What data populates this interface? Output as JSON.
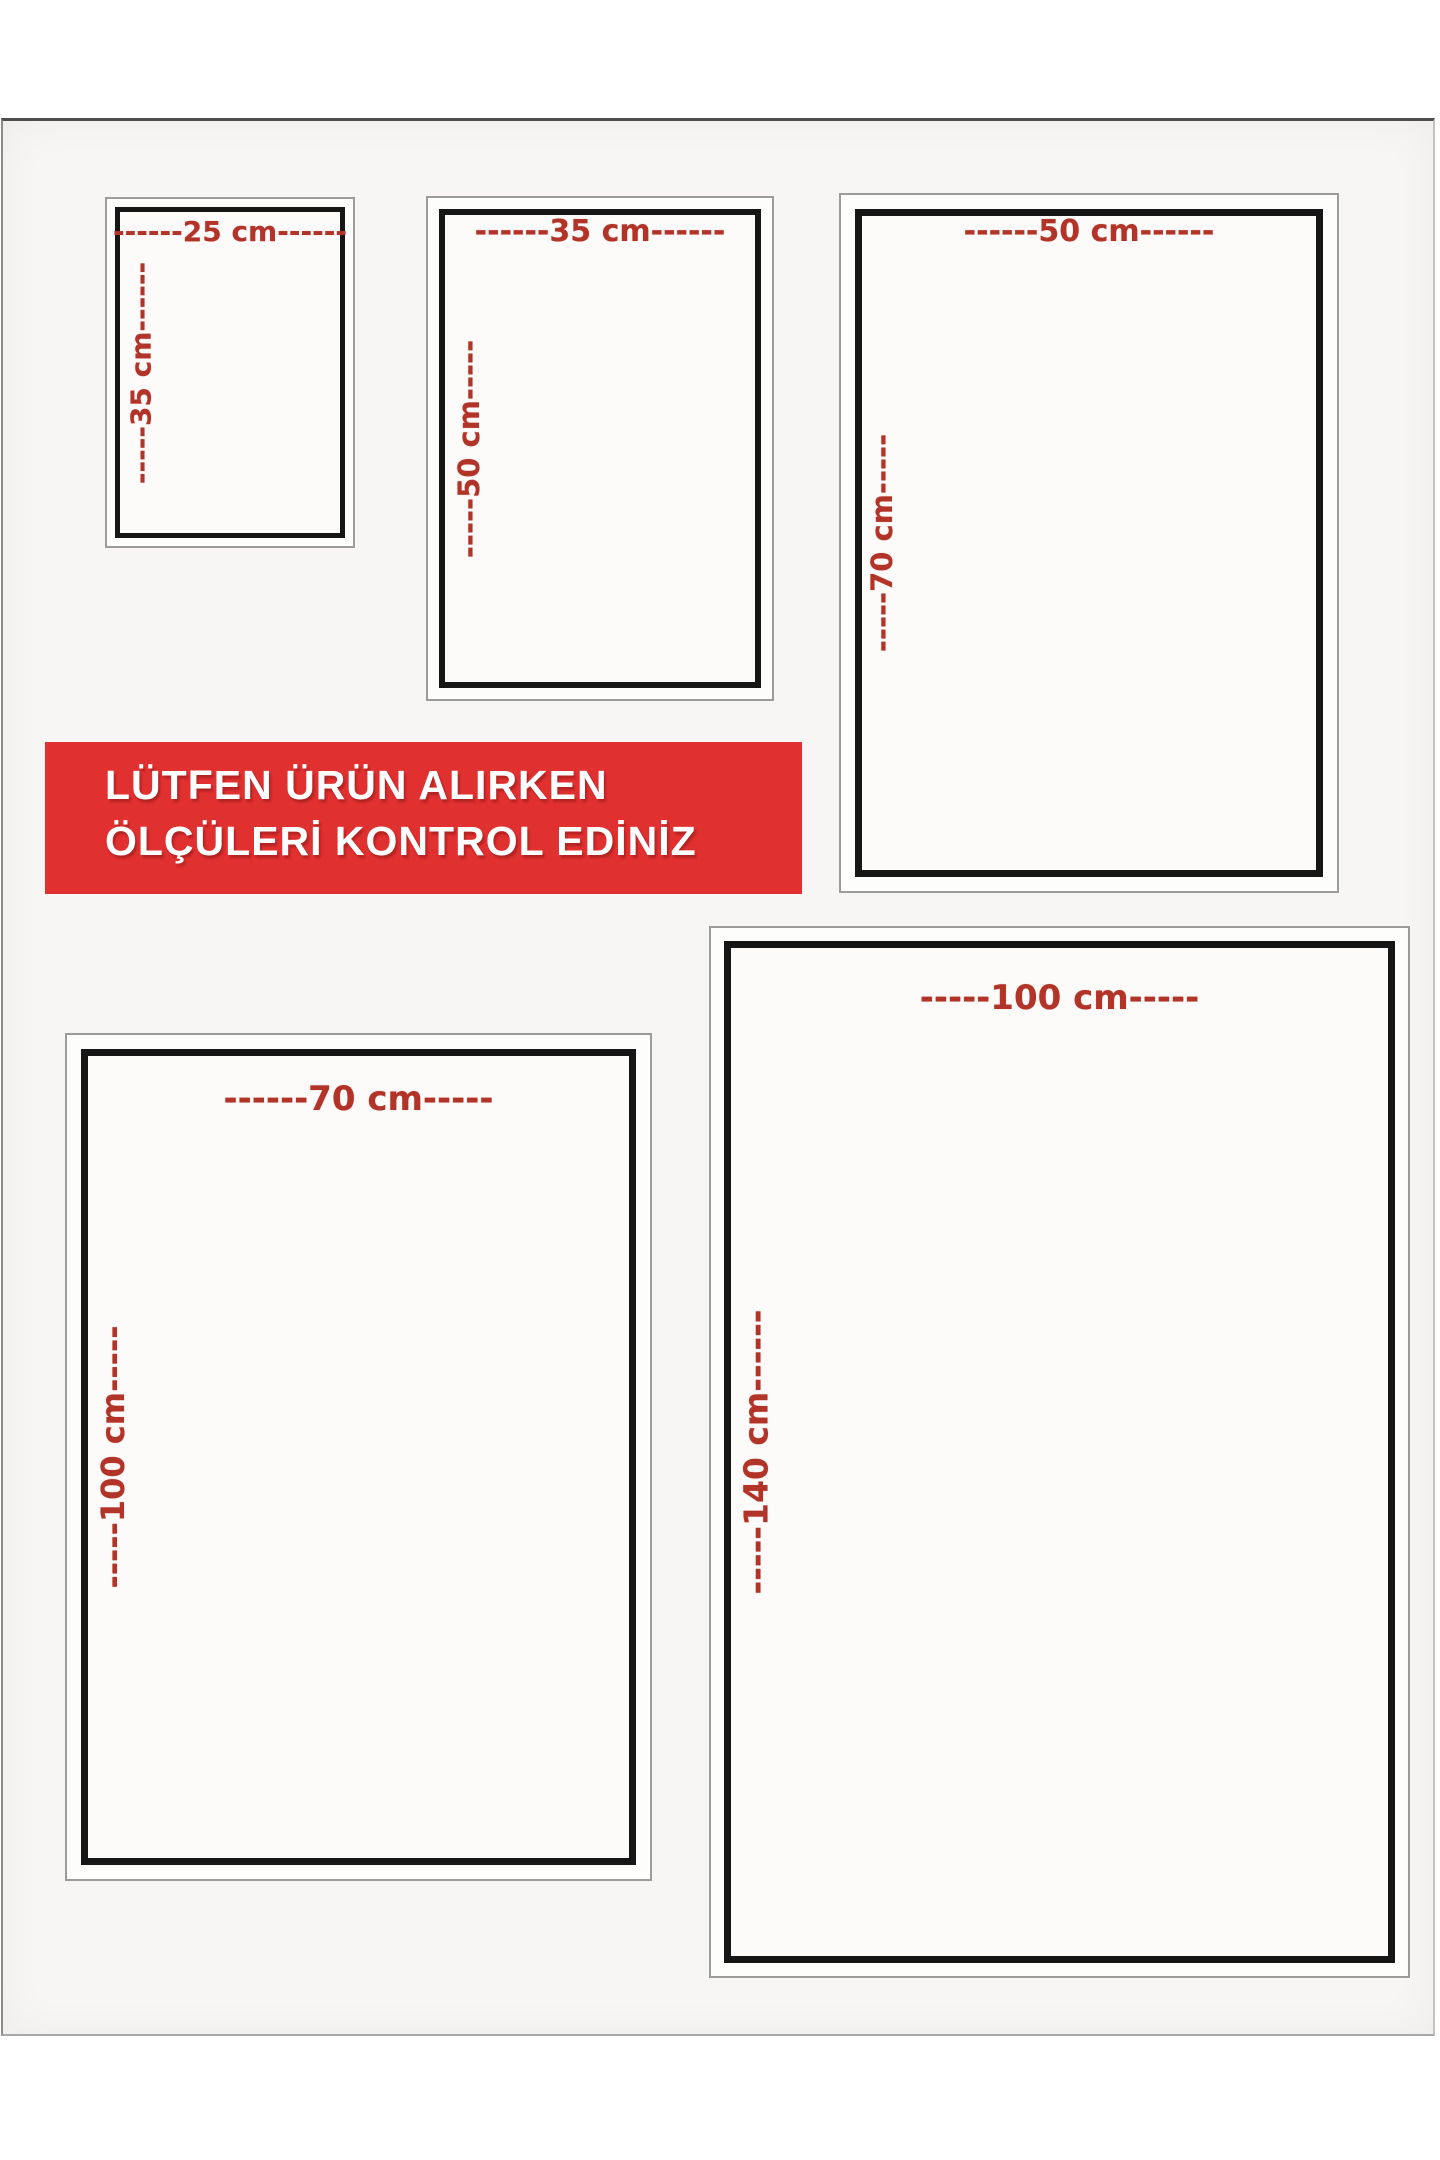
{
  "banner": {
    "line1": "LÜTFEN ÜRÜN ALIRKEN",
    "line2": "ÖLÇÜLERİ KONTROL EDİNİZ",
    "background_color": "#e13030",
    "text_color": "#ffffff"
  },
  "colors": {
    "dimension_text": "#b23327",
    "frame_black": "#161616",
    "frame_gray": "#9c9c9c",
    "photo_background": "#f7f6f4"
  },
  "sizes": [
    {
      "name": "25x35",
      "width_cm": 25,
      "height_cm": 35,
      "width_label": "------25 cm------",
      "height_label": "-----35 cm------"
    },
    {
      "name": "35x50",
      "width_cm": 35,
      "height_cm": 50,
      "width_label": "------35 cm------",
      "height_label": "-----50 cm-----"
    },
    {
      "name": "50x70",
      "width_cm": 50,
      "height_cm": 70,
      "width_label": "------50 cm------",
      "height_label": "-----70 cm-----"
    },
    {
      "name": "70x100",
      "width_cm": 70,
      "height_cm": 100,
      "width_label": "------70 cm-----",
      "height_label": "-----100 cm-----"
    },
    {
      "name": "100x140",
      "width_cm": 100,
      "height_cm": 140,
      "width_label": "-----100 cm-----",
      "height_label": "-----140 cm------"
    }
  ]
}
